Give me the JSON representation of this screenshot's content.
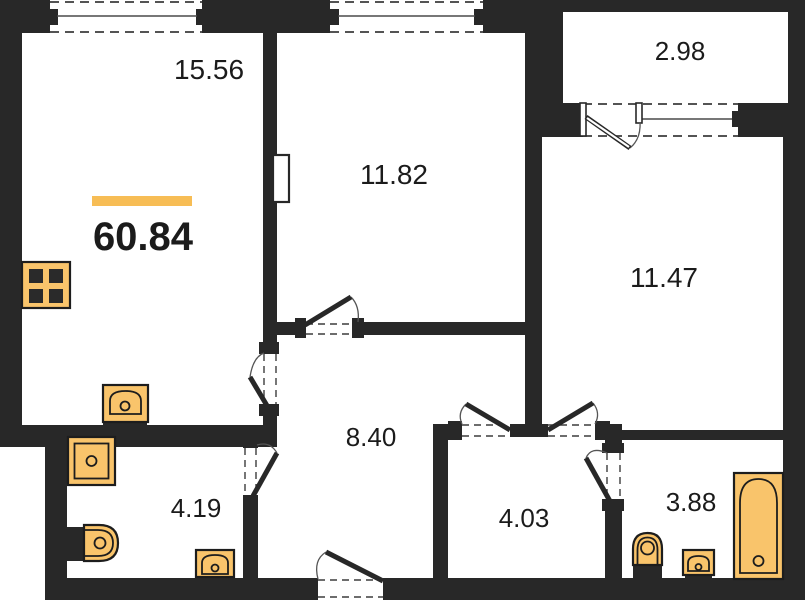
{
  "plan": {
    "type": "apartment-floor-plan",
    "total": {
      "area": "60.84"
    },
    "rooms": {
      "living_kitchen": "15.56",
      "bedroom_1": "11.82",
      "balcony": "2.98",
      "bedroom_2": "11.47",
      "hallway": "8.40",
      "bathroom_1": "4.19",
      "inner_hall": "4.03",
      "bathroom_2": "3.88"
    },
    "fixtures": {
      "stove": "stove-burner-grid",
      "kitchen_sink": "kitchen-sink",
      "shower": "shower-tray",
      "toilet_1": "toilet",
      "washbasin_1": "washbasin",
      "toilet_2": "toilet",
      "washbasin_2": "washbasin",
      "bathtub": "bathtub"
    },
    "colors": {
      "wall": "#282828",
      "fixture_fill": "#F9C46B",
      "accent_bar": "#F7BD55",
      "text": "#1b1b1b",
      "background": "#ffffff"
    }
  }
}
